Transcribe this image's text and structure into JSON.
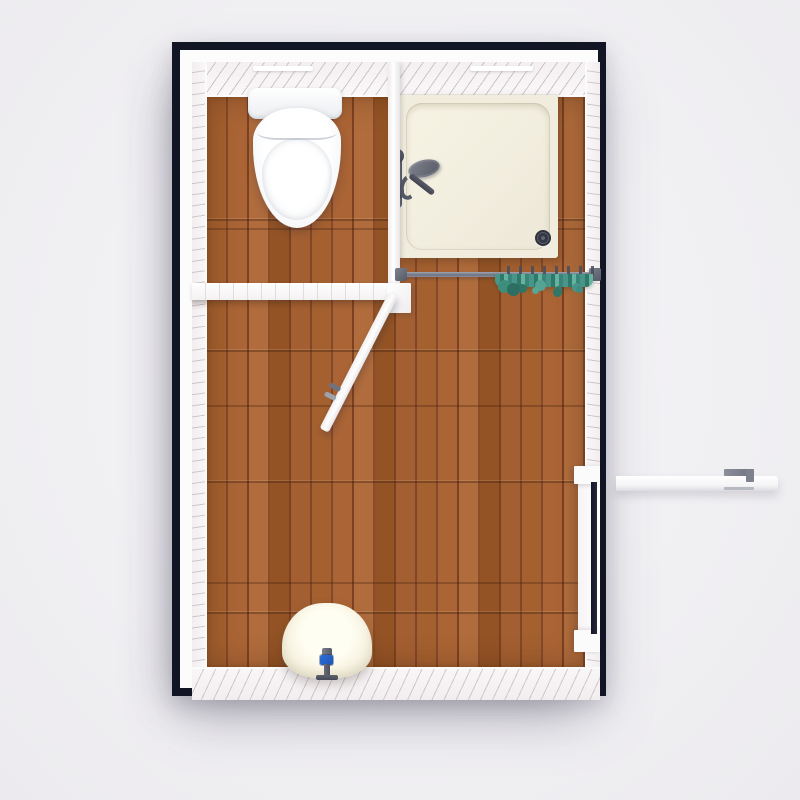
{
  "scene": {
    "title": "Bathroom floor plan, 3D top-down render",
    "type": "3d-floor-plan",
    "rooms": [
      {
        "name": "toilet-room",
        "position": "top-left",
        "floor": "wood planks",
        "fixtures": [
          "toilet"
        ]
      },
      {
        "name": "shower-area",
        "position": "top-right",
        "floor": "wood planks",
        "fixtures": [
          "shower-tray",
          "shower-faucet",
          "shower-drain",
          "curtain-rod",
          "shower-curtain"
        ]
      },
      {
        "name": "main-room",
        "position": "bottom",
        "floor": "wood planks",
        "fixtures": [
          "pedestal-sink",
          "ceiling-light-slits"
        ]
      }
    ],
    "doors": [
      {
        "name": "interior-door",
        "location": "partition between toilet room and main room",
        "state": "open",
        "swing": "into main room, diagonal"
      },
      {
        "name": "exterior-door",
        "location": "right wall, lower half",
        "state": "open",
        "swing": "outward to the right"
      }
    ],
    "walls": {
      "outline": "dark navy frame",
      "interior_faces": "white planked walls seen at an angle (diagonal hatch)",
      "partitions": "white plank wall tops with seam ticks"
    }
  },
  "colors": {
    "bg_center": "#f6f5f8",
    "bg_edge": "#f0eff2",
    "wall_outline": "#121524",
    "wall_top": "#ffffff",
    "wall_face": "#f6f2f3",
    "wall_hatch": "#cfc7ca",
    "floor_wood_base": "#9b5a31",
    "floor_wood_dark": "#7c4121",
    "floor_wood_light": "#b06c3c",
    "shower_tray": "#f1edde",
    "fixture_white": "#fdfdfd",
    "metal_gray": "#5f6370",
    "curtain_teal": "#48968a",
    "handle_blue": "#2e6fd6",
    "door_gap_dark": "#14172a"
  }
}
